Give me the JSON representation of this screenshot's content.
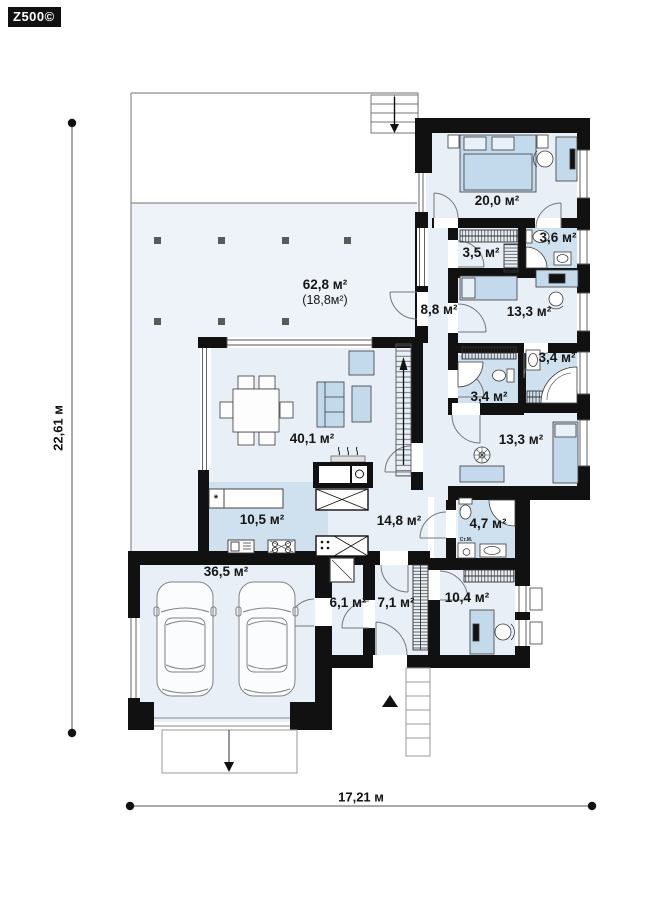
{
  "meta": {
    "brand": "Z500©"
  },
  "dimensions": {
    "width_label": "17,21 м",
    "height_label": "22,61 м"
  },
  "rooms": [
    {
      "id": "terrace",
      "area": "62,8 м²",
      "area_note": "(18,8м²)"
    },
    {
      "id": "living-room",
      "area": "40,1 м²"
    },
    {
      "id": "kitchen",
      "area": "10,5 м²"
    },
    {
      "id": "garage",
      "area": "36,5 м²"
    },
    {
      "id": "hall",
      "area": "14,8 м²"
    },
    {
      "id": "utility",
      "area": "6,1 м²"
    },
    {
      "id": "entry",
      "area": "7,1 м²"
    },
    {
      "id": "office",
      "area": "10,4 м²"
    },
    {
      "id": "bathroom-47",
      "area": "4,7 м²"
    },
    {
      "id": "bedroom-133-lower",
      "area": "13,3 м²"
    },
    {
      "id": "bathroom-34-left",
      "area": "3,4 м²"
    },
    {
      "id": "bathroom-34-right",
      "area": "3,4 м²"
    },
    {
      "id": "bedroom-133-upper",
      "area": "13,3 м²"
    },
    {
      "id": "corridor",
      "area": "8,8 м²"
    },
    {
      "id": "wardrobe",
      "area": "3,5 м²"
    },
    {
      "id": "bathroom-36",
      "area": "3,6 м²"
    },
    {
      "id": "bedroom-master",
      "area": "20,0 м²"
    }
  ],
  "equipment": {
    "washing_machine": "Ст.М.",
    "kitchen_star": "*"
  },
  "colors": {
    "wall": "#111111",
    "room_fill": "#e9eff6",
    "terrace_fill": "#edf3f9",
    "kitchen_fill": "#cfe1ef",
    "furniture_fill": "#c3d9ec",
    "outline": "#8c8c8c"
  }
}
